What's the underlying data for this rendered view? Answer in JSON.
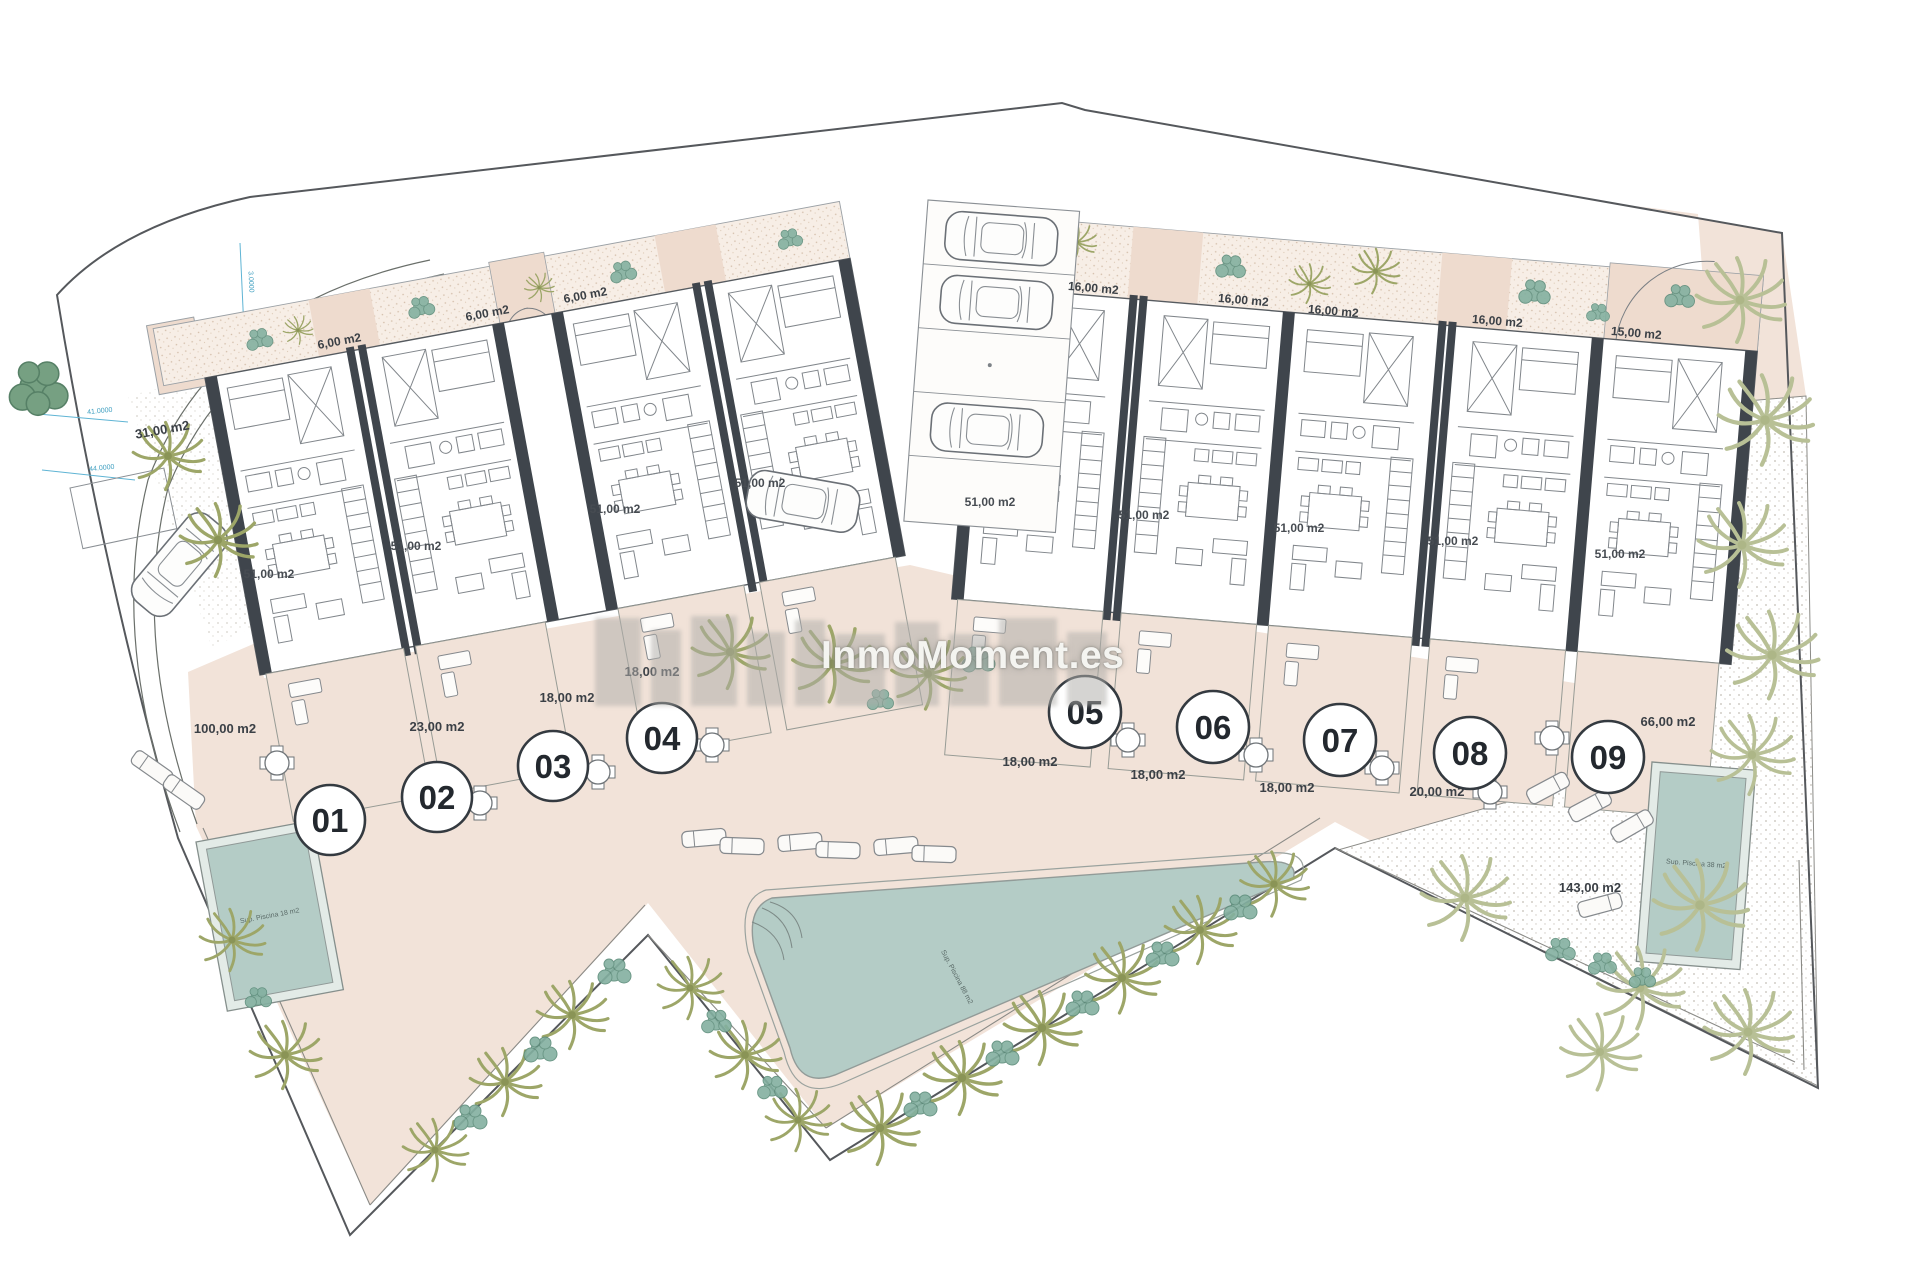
{
  "plan": {
    "watermark_text": "InmoMoment.es",
    "units": [
      {
        "number": "01",
        "unit_area": "51,00 m2",
        "terrace_area": "100,00 m2",
        "garden_area": "6,00 m2"
      },
      {
        "number": "02",
        "unit_area": "51,00 m2",
        "terrace_area": "23,00 m2",
        "garden_area": "6,00 m2"
      },
      {
        "number": "03",
        "unit_area": "51,00 m2",
        "terrace_area": "18,00 m2",
        "garden_area": "6,00 m2"
      },
      {
        "number": "04",
        "unit_area": "51,00 m2",
        "terrace_area": "18,00 m2"
      },
      {
        "number": "05",
        "unit_area": "51,00 m2",
        "terrace_area": "18,00 m2",
        "garden_area": "16,00 m2"
      },
      {
        "number": "06",
        "unit_area": "51,00 m2",
        "terrace_area": "18,00 m2",
        "garden_area": "16,00 m2"
      },
      {
        "number": "07",
        "unit_area": "51,00 m2",
        "terrace_area": "18,00 m2",
        "garden_area": "16,00 m2"
      },
      {
        "number": "08",
        "unit_area": "51,00 m2",
        "terrace_area": "20,00 m2",
        "garden_area": "16,00 m2"
      },
      {
        "number": "09",
        "unit_area": "51,00 m2",
        "garden_area": "15,00 m2"
      }
    ],
    "site_areas": {
      "left_yard": "31,00 m2",
      "right_side": "66,00 m2",
      "right_gravel": "143,00 m2"
    },
    "pool_labels": {
      "left": "Sup. Piscina 18 m2",
      "center": "Sup. Piscina 88 m2",
      "right": "Sup. Piscina 38 m2"
    },
    "dimensions": {
      "top": "3.0000",
      "left_upper": "41.0000",
      "left_lower": "44.0000"
    }
  }
}
